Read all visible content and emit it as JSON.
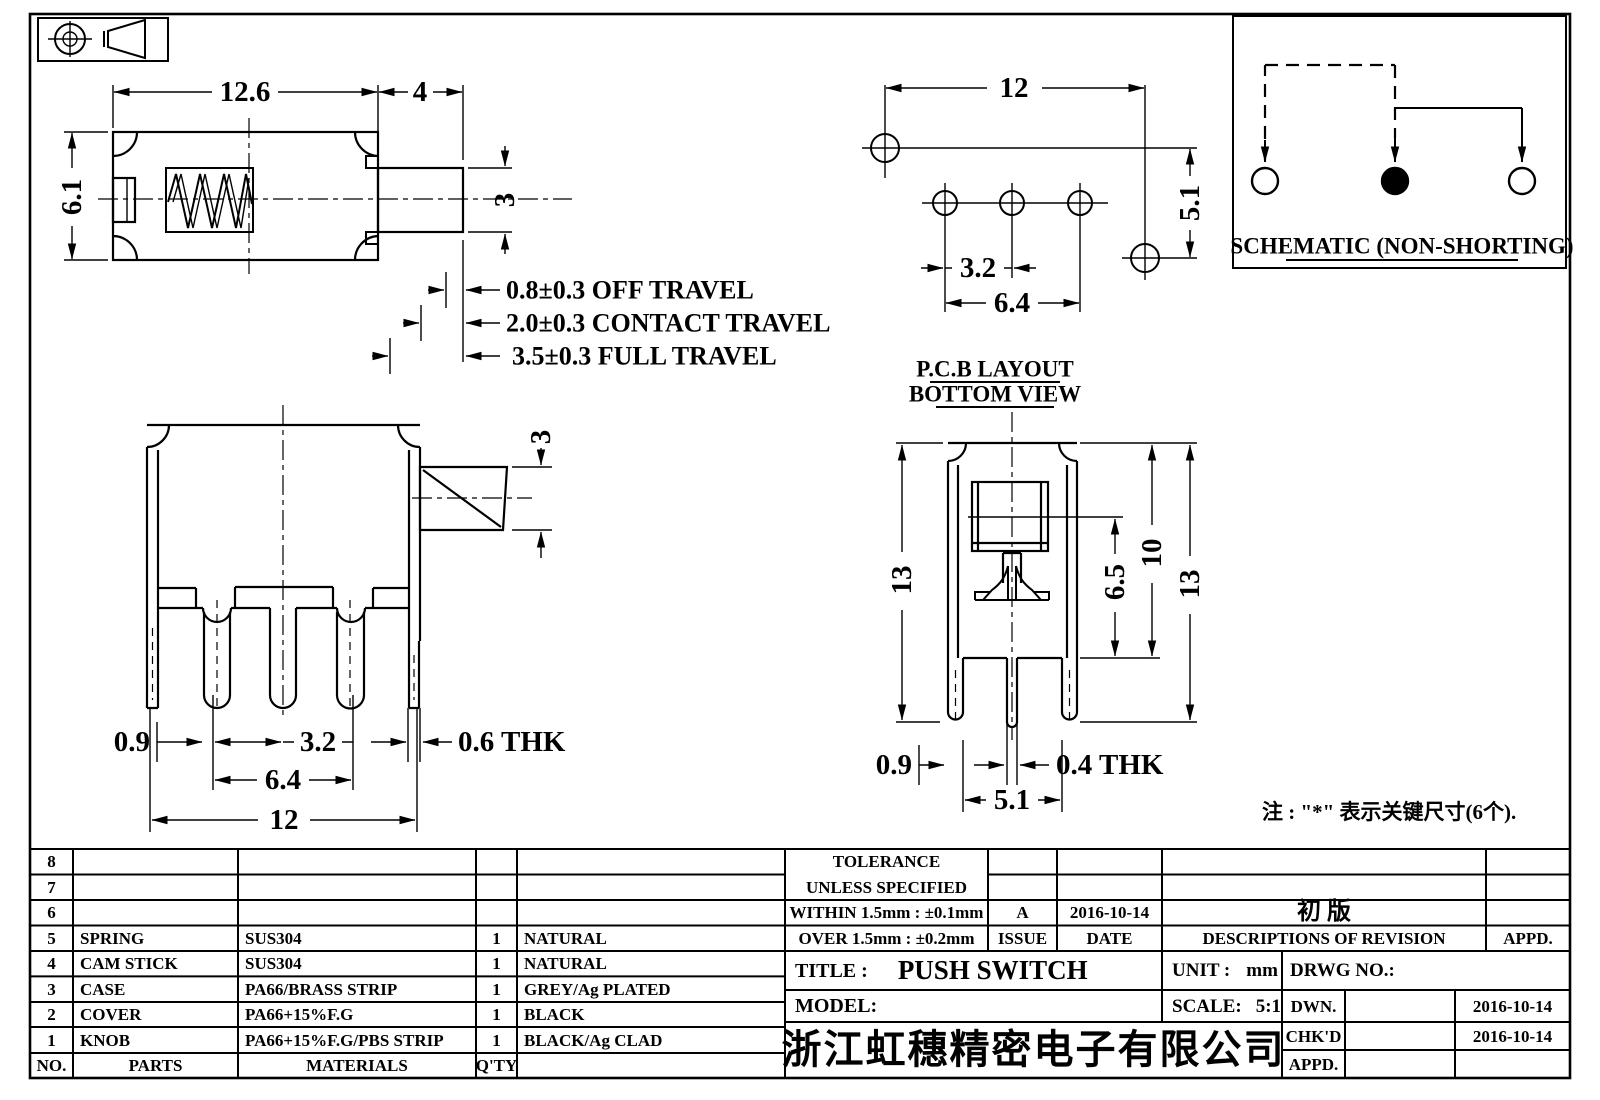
{
  "dims": {
    "top_width": "12.6",
    "top_plunger_len": "4",
    "top_height": "6.1",
    "top_plunger_h": "3",
    "travel1": "0.8±0.3 OFF TRAVEL",
    "travel2": "2.0±0.3 CONTACT TRAVEL",
    "travel3": "3.5±0.3 FULL TRAVEL",
    "pcb_width": "12",
    "pcb_height": "5.1",
    "pcb_pitch": "3.2",
    "pcb_span": "6.4",
    "front_knob_h": "3",
    "front_d09": "0.9",
    "front_pitch": "3.2",
    "front_span": "6.4",
    "front_width": "12",
    "front_thk": "0.6 THK",
    "side_h_left": "13",
    "side_d65": "6.5",
    "side_d10": "10",
    "side_h_right": "13",
    "side_d09": "0.9",
    "side_thk": "0.4 THK",
    "side_span": "5.1"
  },
  "labels": {
    "pcb_caption1": "P.C.B LAYOUT",
    "pcb_caption2": "BOTTOM VIEW",
    "schematic_caption": "SCHEMATIC (NON-SHORTING)",
    "note": "注 : \"*\"  表示关键尺寸(6个)."
  },
  "parts_table": {
    "headers": {
      "no": "NO.",
      "parts": "PARTS",
      "materials": "MATERIALS",
      "qty": "Q'TY"
    },
    "rows": [
      {
        "no": "8",
        "part": "",
        "material": "",
        "qty": "",
        "finish": ""
      },
      {
        "no": "7",
        "part": "",
        "material": "",
        "qty": "",
        "finish": ""
      },
      {
        "no": "6",
        "part": "",
        "material": "",
        "qty": "",
        "finish": ""
      },
      {
        "no": "5",
        "part": "SPRING",
        "material": "SUS304",
        "qty": "1",
        "finish": "NATURAL"
      },
      {
        "no": "4",
        "part": "CAM STICK",
        "material": "SUS304",
        "qty": "1",
        "finish": "NATURAL"
      },
      {
        "no": "3",
        "part": "CASE",
        "material": "PA66/BRASS STRIP",
        "qty": "1",
        "finish": "GREY/Ag PLATED"
      },
      {
        "no": "2",
        "part": "COVER",
        "material": "PA66+15%F.G",
        "qty": "1",
        "finish": "BLACK"
      },
      {
        "no": "1",
        "part": "KNOB",
        "material": "PA66+15%F.G/PBS STRIP",
        "qty": "1",
        "finish": "BLACK/Ag CLAD"
      }
    ]
  },
  "title_block": {
    "tolerance_line1": "TOLERANCE",
    "tolerance_line2": "UNLESS  SPECIFIED",
    "within": "WITHIN 1.5mm : ±0.1mm",
    "over": "OVER 1.5mm : ±0.2mm",
    "issue_value": "A",
    "issue_label": "ISSUE",
    "date_value": "2016-10-14",
    "date_label": "DATE",
    "revision_value": "初  版",
    "revision_label": "DESCRIPTIONS OF REVISION",
    "appd_header_label": "APPD.",
    "title_label": "TITLE :",
    "title_value": "PUSH SWITCH",
    "model_label": "MODEL:",
    "unit_label": "UNIT :",
    "unit_value": "mm",
    "scale_label": "SCALE:",
    "scale_value": "5:1",
    "drwg_label": "DRWG NO.:",
    "dwn_label": "DWN.",
    "dwn_date": "2016-10-14",
    "chkd_label": "CHK'D",
    "chkd_date": "2016-10-14",
    "appd_row_label": "APPD.",
    "company": "浙江虹穗精密电子有限公司"
  }
}
